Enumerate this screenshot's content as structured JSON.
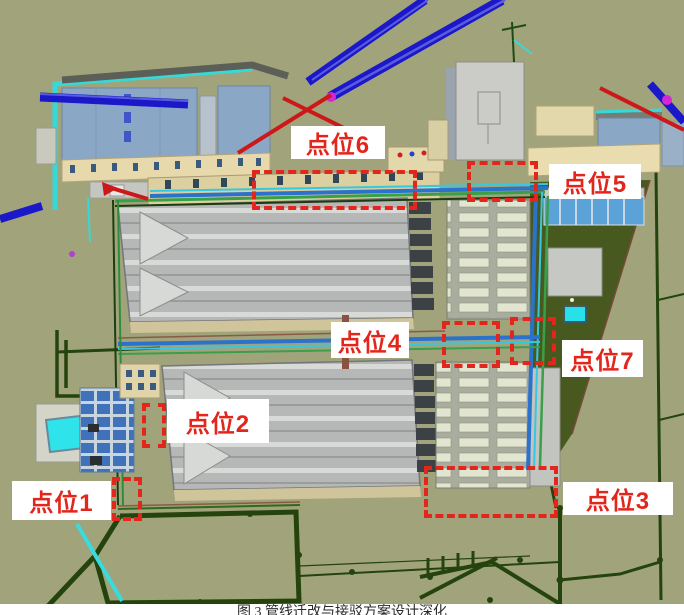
{
  "figure": {
    "type": "3d-bim-pipeline-model-with-annotations",
    "caption": "图 3 管线迁改与接驳方案设计深化",
    "annotations": [
      {
        "label": "点位1"
      },
      {
        "label": "点位2"
      },
      {
        "label": "点位3"
      },
      {
        "label": "点位4"
      },
      {
        "label": "点位5"
      },
      {
        "label": "点位6"
      },
      {
        "label": "点位7"
      }
    ],
    "colors": {
      "annotation_red": "#e3261c",
      "label_background": "#ffffff",
      "terrain_olive": "#a1a47b",
      "east_field_green": "#47591f",
      "pipe_dark_blue": "#1a18c8",
      "pipe_cyan": "#36d8d8",
      "pipe_dark_green": "#25430d",
      "hall_roof_gray": "#b5b8b6",
      "building_blue_gray": "#8ba7c6",
      "building_cream": "#e7d9ab",
      "magenta_node": "#d428d4"
    }
  }
}
